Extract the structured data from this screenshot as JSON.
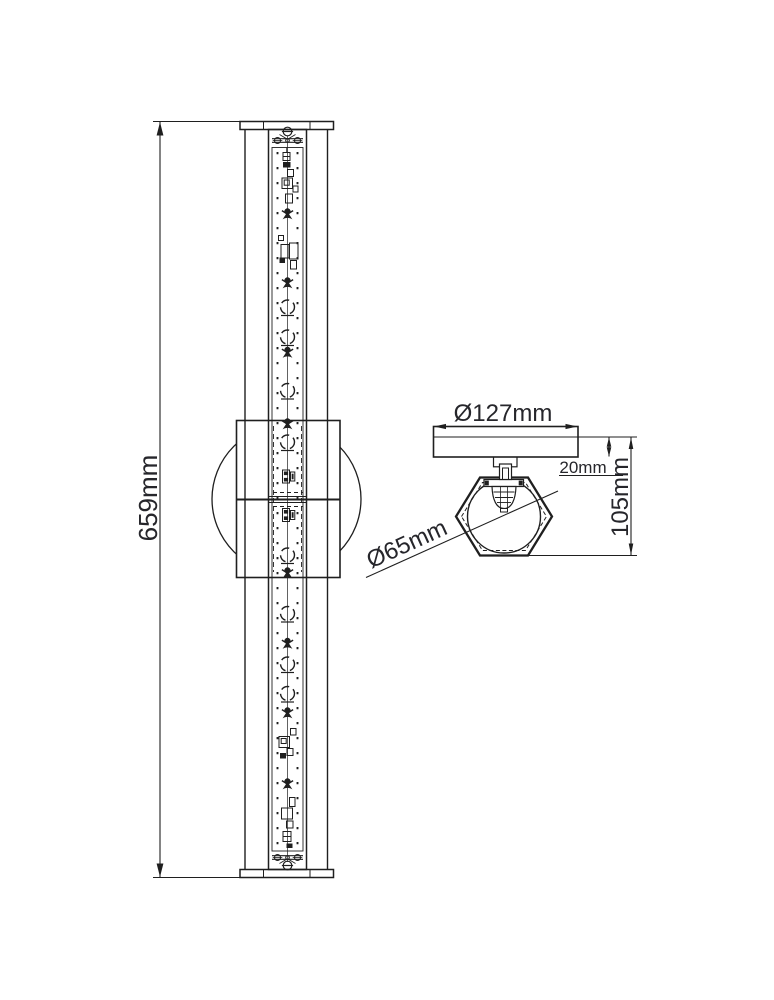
{
  "drawing": {
    "background_color": "#ffffff",
    "line_color": "#1f1f1f",
    "text_color": "#26262b",
    "dimensions": {
      "height": "659mm",
      "plate_diameter": "Ø127mm",
      "plate_thickness": "20mm",
      "projection": "105mm",
      "shade_diameter": "Ø65mm"
    }
  }
}
